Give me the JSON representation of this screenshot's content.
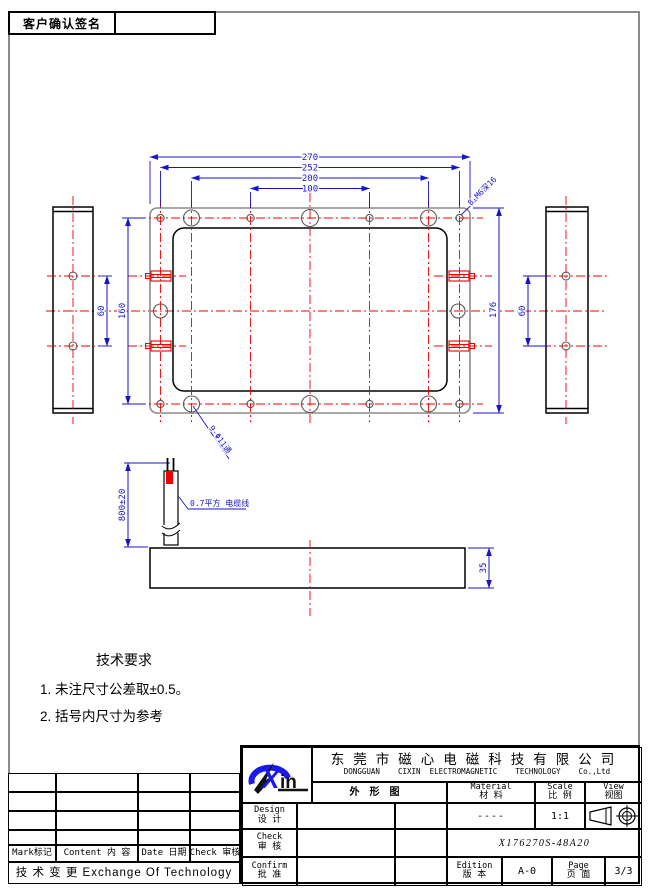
{
  "signature": {
    "label": "客户确认签名"
  },
  "drawing": {
    "dims": {
      "w270": "270",
      "w252": "252",
      "w200": "200",
      "w100": "100",
      "h160": "160",
      "h176": "176",
      "side_left_60": "60",
      "side_right_60": "60",
      "cable_800": "800±20",
      "thickness_35": "35"
    },
    "leaders": {
      "screws": "8-M6深16",
      "holes": "9-Φ11通",
      "cable": "0.7平方 电缆线"
    }
  },
  "tech_requirements": {
    "title": "技术要求",
    "items": [
      "1. 未注尺寸公差取±0.5。",
      "2. 括号内尺寸为参考"
    ]
  },
  "title_block": {
    "company_cn": "东莞市磁心电磁科技有限公司",
    "company_en": "DONGGUAN    CIXIN  ELECTROMAGNETIC    TECHNOLOGY    Co.,Ltd",
    "drawing_name": "外形图",
    "material_en": "Material",
    "material_cn": "材  料",
    "scale_en": "Scale",
    "scale_cn": "比 例",
    "view_en": "View",
    "view_cn": "视图",
    "material_value": "----",
    "scale_value": "1:1",
    "design_en": "Design",
    "design_cn": "设 计",
    "check_en": "Check",
    "check_cn": "审 核",
    "confirm_en": "Confirm",
    "confirm_cn": "批 准",
    "part_number": "X176270S-48A20",
    "edition_en": "Edition",
    "edition_cn": "版 本",
    "edition_value": "A-0",
    "page_en": "Page",
    "page_cn": "页 面",
    "page_value": "3/3"
  },
  "revision_table": {
    "col_mark": "Mark标记",
    "col_content": "Content 内 容",
    "col_date": "Date 日期",
    "col_check": "Check 审核",
    "footer": "技 术 变 更   Exchange Of Technology"
  },
  "logo": {
    "text": "Xin"
  }
}
